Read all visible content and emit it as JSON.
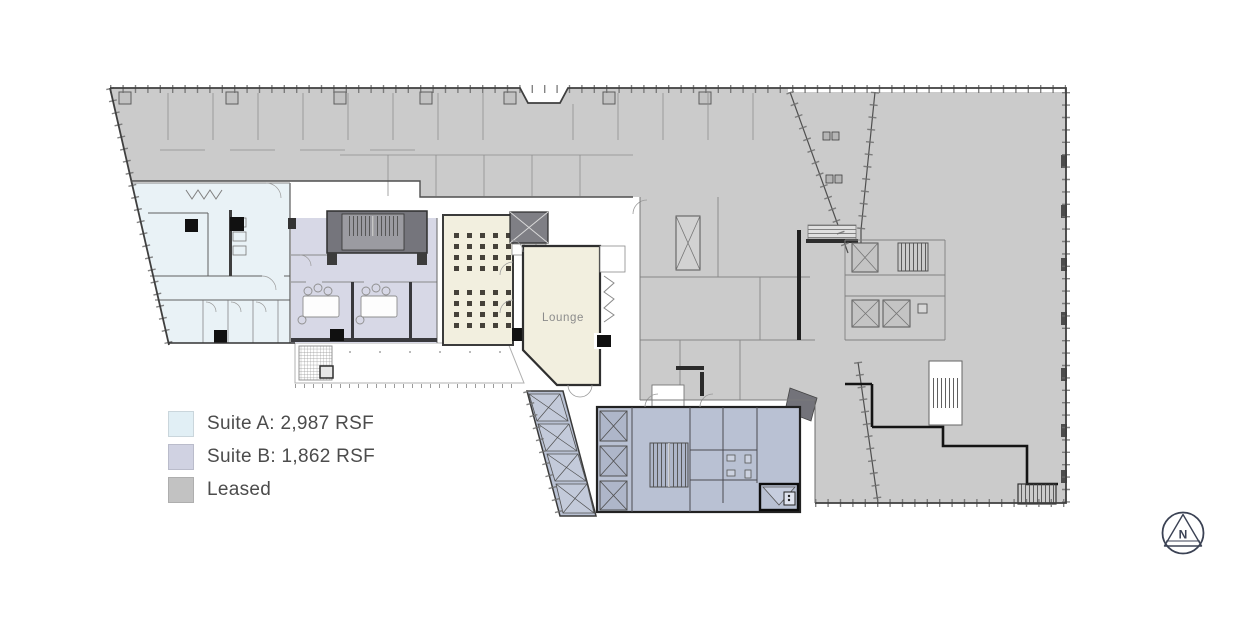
{
  "legend": {
    "items": [
      {
        "name": "suite-a",
        "label": "Suite A: 2,987 RSF",
        "swatch_color": "#e1eff5"
      },
      {
        "name": "suite-b",
        "label": "Suite B: 1,862 RSF",
        "swatch_color": "#d0d2e2"
      },
      {
        "name": "leased",
        "label": "Leased",
        "swatch_color": "#c2c2c2"
      }
    ]
  },
  "floor_plan": {
    "room_labels": [
      {
        "name": "lounge",
        "label": "Lounge"
      }
    ],
    "zones": [
      {
        "name": "Suite A",
        "area": "2,987 RSF",
        "fill": "#e9f2f6"
      },
      {
        "name": "Suite B",
        "area": "1,862 RSF",
        "fill": "#d7d8e6"
      },
      {
        "name": "Leased",
        "fill": "#cbcbcb"
      },
      {
        "name": "Lounge",
        "fill": "#f2efdf"
      },
      {
        "name": "Building core",
        "fill": "#b9c1d3"
      }
    ]
  },
  "north_indicator": {
    "label": "N"
  },
  "colors": {
    "leased_fill": "#cbcbcb",
    "suite_a_fill": "#e9f2f6",
    "suite_b_fill": "#d7d8e6",
    "lounge_fill": "#f2efdf",
    "core_fill": "#b9c1d3",
    "wall": "#4a4a4a",
    "legend_text": "#4c4c4c",
    "north": "#3b4254"
  }
}
